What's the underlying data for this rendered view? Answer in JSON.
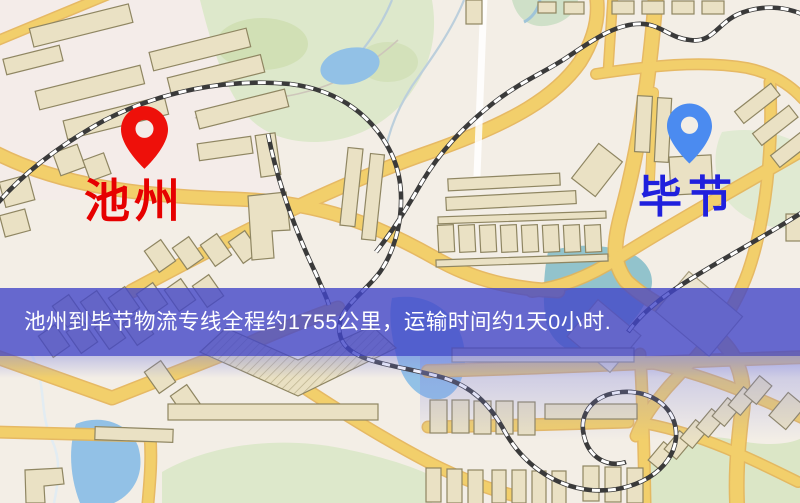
{
  "origin": {
    "name": "池州",
    "pin_color": "#ee100a",
    "label_color": "#e60000"
  },
  "destination": {
    "name": "毕节",
    "pin_color": "#4b8bf0",
    "label_color": "#2020dd"
  },
  "banner": {
    "text": "池州到毕节物流专线全程约1755公里，运输时间约1天0小时.",
    "background": "rgba(66,70,200,0.8)",
    "text_color": "#ffffff",
    "distance_km": "1755",
    "duration_days": "1",
    "duration_hours": "0"
  },
  "palette": {
    "map_background": "#f3eee6",
    "road": "#f2cf6b",
    "road_casing": "#e5b457",
    "white_road": "#ffffff",
    "building_fill": "#eae1c4",
    "building_stroke": "#8f8662",
    "park": "#dde8cb",
    "water": "#92c1e6",
    "pond": "#8cc0ca",
    "railway": "#3a3a3a",
    "railway_dash": "#ffffff"
  }
}
